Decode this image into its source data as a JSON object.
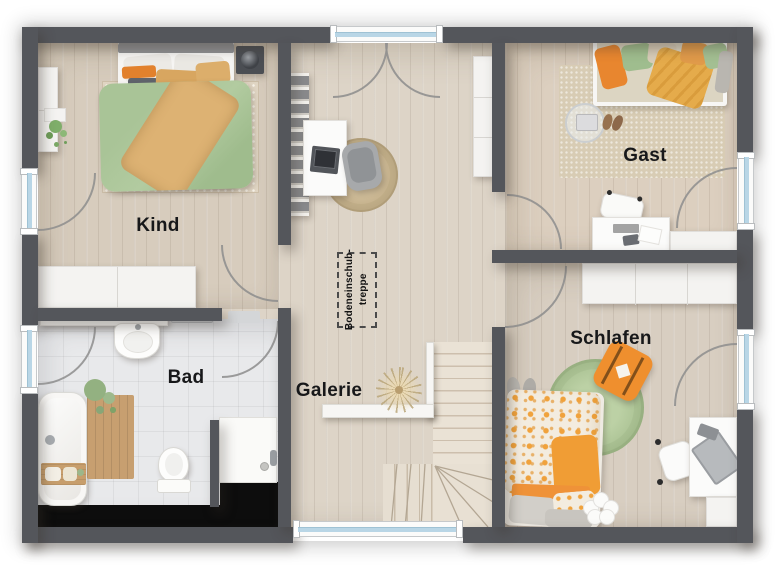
{
  "plan": {
    "type": "floor-plan-upper-floor",
    "rooms": [
      {
        "id": "kind",
        "label": "Kind"
      },
      {
        "id": "gast",
        "label": "Gast"
      },
      {
        "id": "bad",
        "label": "Bad"
      },
      {
        "id": "galerie",
        "label": "Galerie"
      },
      {
        "id": "schlafen",
        "label": "Schlafen"
      }
    ],
    "annotations": {
      "attic_hatch": {
        "line1": "Bodeneinschub-",
        "line2": "treppe"
      }
    },
    "colors": {
      "wall": "#54565b",
      "floor_wood": "#dcd3c6",
      "floor_tile": "#e8e9eb",
      "accent_orange": "#ef9a33",
      "accent_green": "#a9c497",
      "window_glass": "#b9d6e6",
      "stair_tread": "#e8e0d3",
      "void": "#0d0d0d"
    }
  }
}
